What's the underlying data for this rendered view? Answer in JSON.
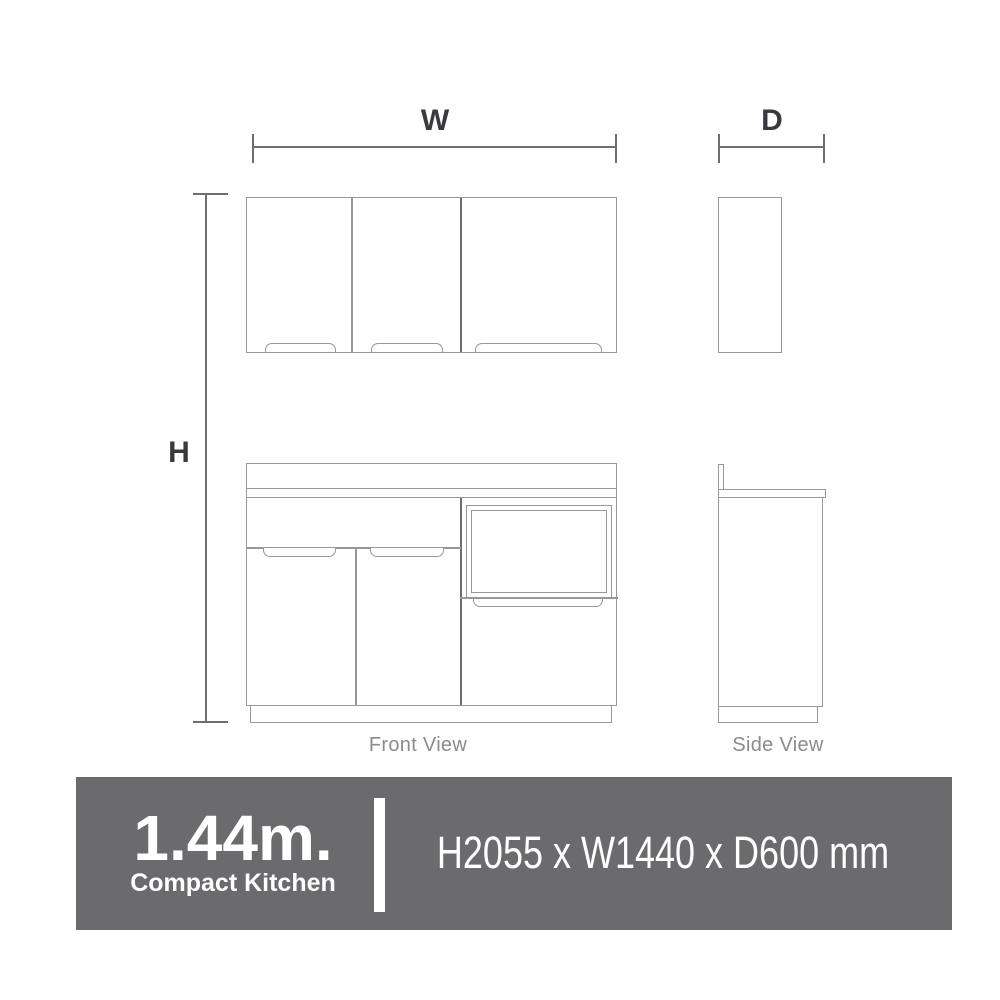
{
  "colors": {
    "line": "#98989c",
    "line_dark": "#6e6e72",
    "dim": "#6e6e72",
    "dim_label": "#3a3a3e",
    "view_label": "#8b8b8e",
    "banner_bg": "#6b6b6e",
    "banner_text": "#ffffff"
  },
  "diagram": {
    "width_label": "W",
    "depth_label": "D",
    "height_label": "H",
    "front_view_label": "Front View",
    "side_view_label": "Side View"
  },
  "banner": {
    "size": "1.44m.",
    "product": "Compact Kitchen",
    "dimensions": "H2055 x W1440 x D600 mm"
  }
}
